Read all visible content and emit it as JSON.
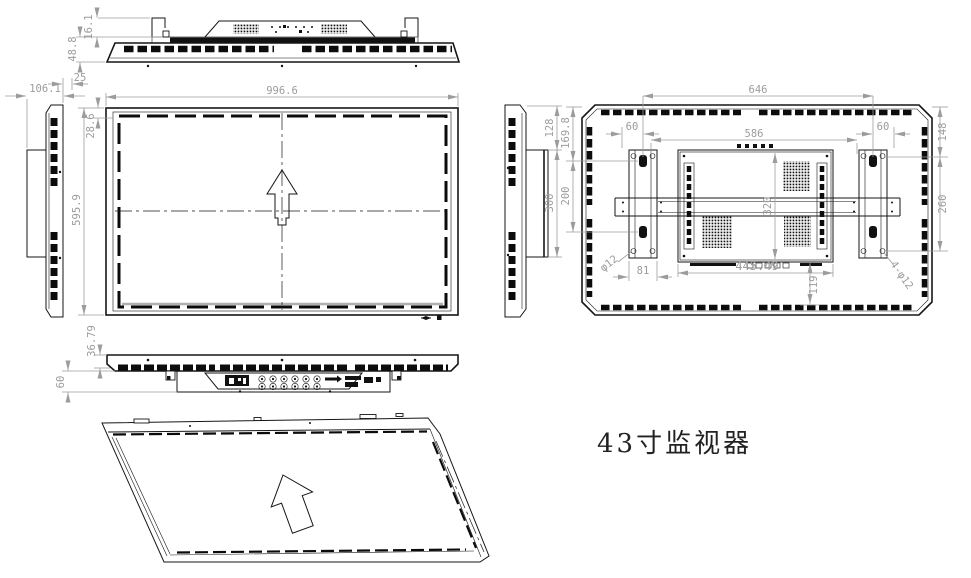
{
  "title": "43寸监视器",
  "dims": {
    "top_hook_height": "16.1",
    "top_total_height": "48.8",
    "side_gap": "25",
    "side_depth": "106.1",
    "front_width": "996.6",
    "front_bezel_top": "28.6",
    "front_height": "595.9",
    "bottom_lip": "36.79",
    "bottom_recess": "60",
    "rside_top_offset": "128",
    "rside_bracket_height": "300",
    "rear_bracket_span": "646",
    "rear_left_hole_offset": "60",
    "rear_right_hole_offset": "60",
    "rear_inner_span": "586",
    "rear_left_top_offset": "169.8",
    "rear_left_hole_pitch": "200",
    "rear_right_top_offset": "148",
    "rear_right_hole_pitch": "260",
    "rear_box_height": "320",
    "rear_box_width": "445.49",
    "rear_bracket_width": "81",
    "rear_box_bottom_offset": "119",
    "rear_hole_dia": "φ12",
    "rear_holes_dia": "4-φ12"
  }
}
